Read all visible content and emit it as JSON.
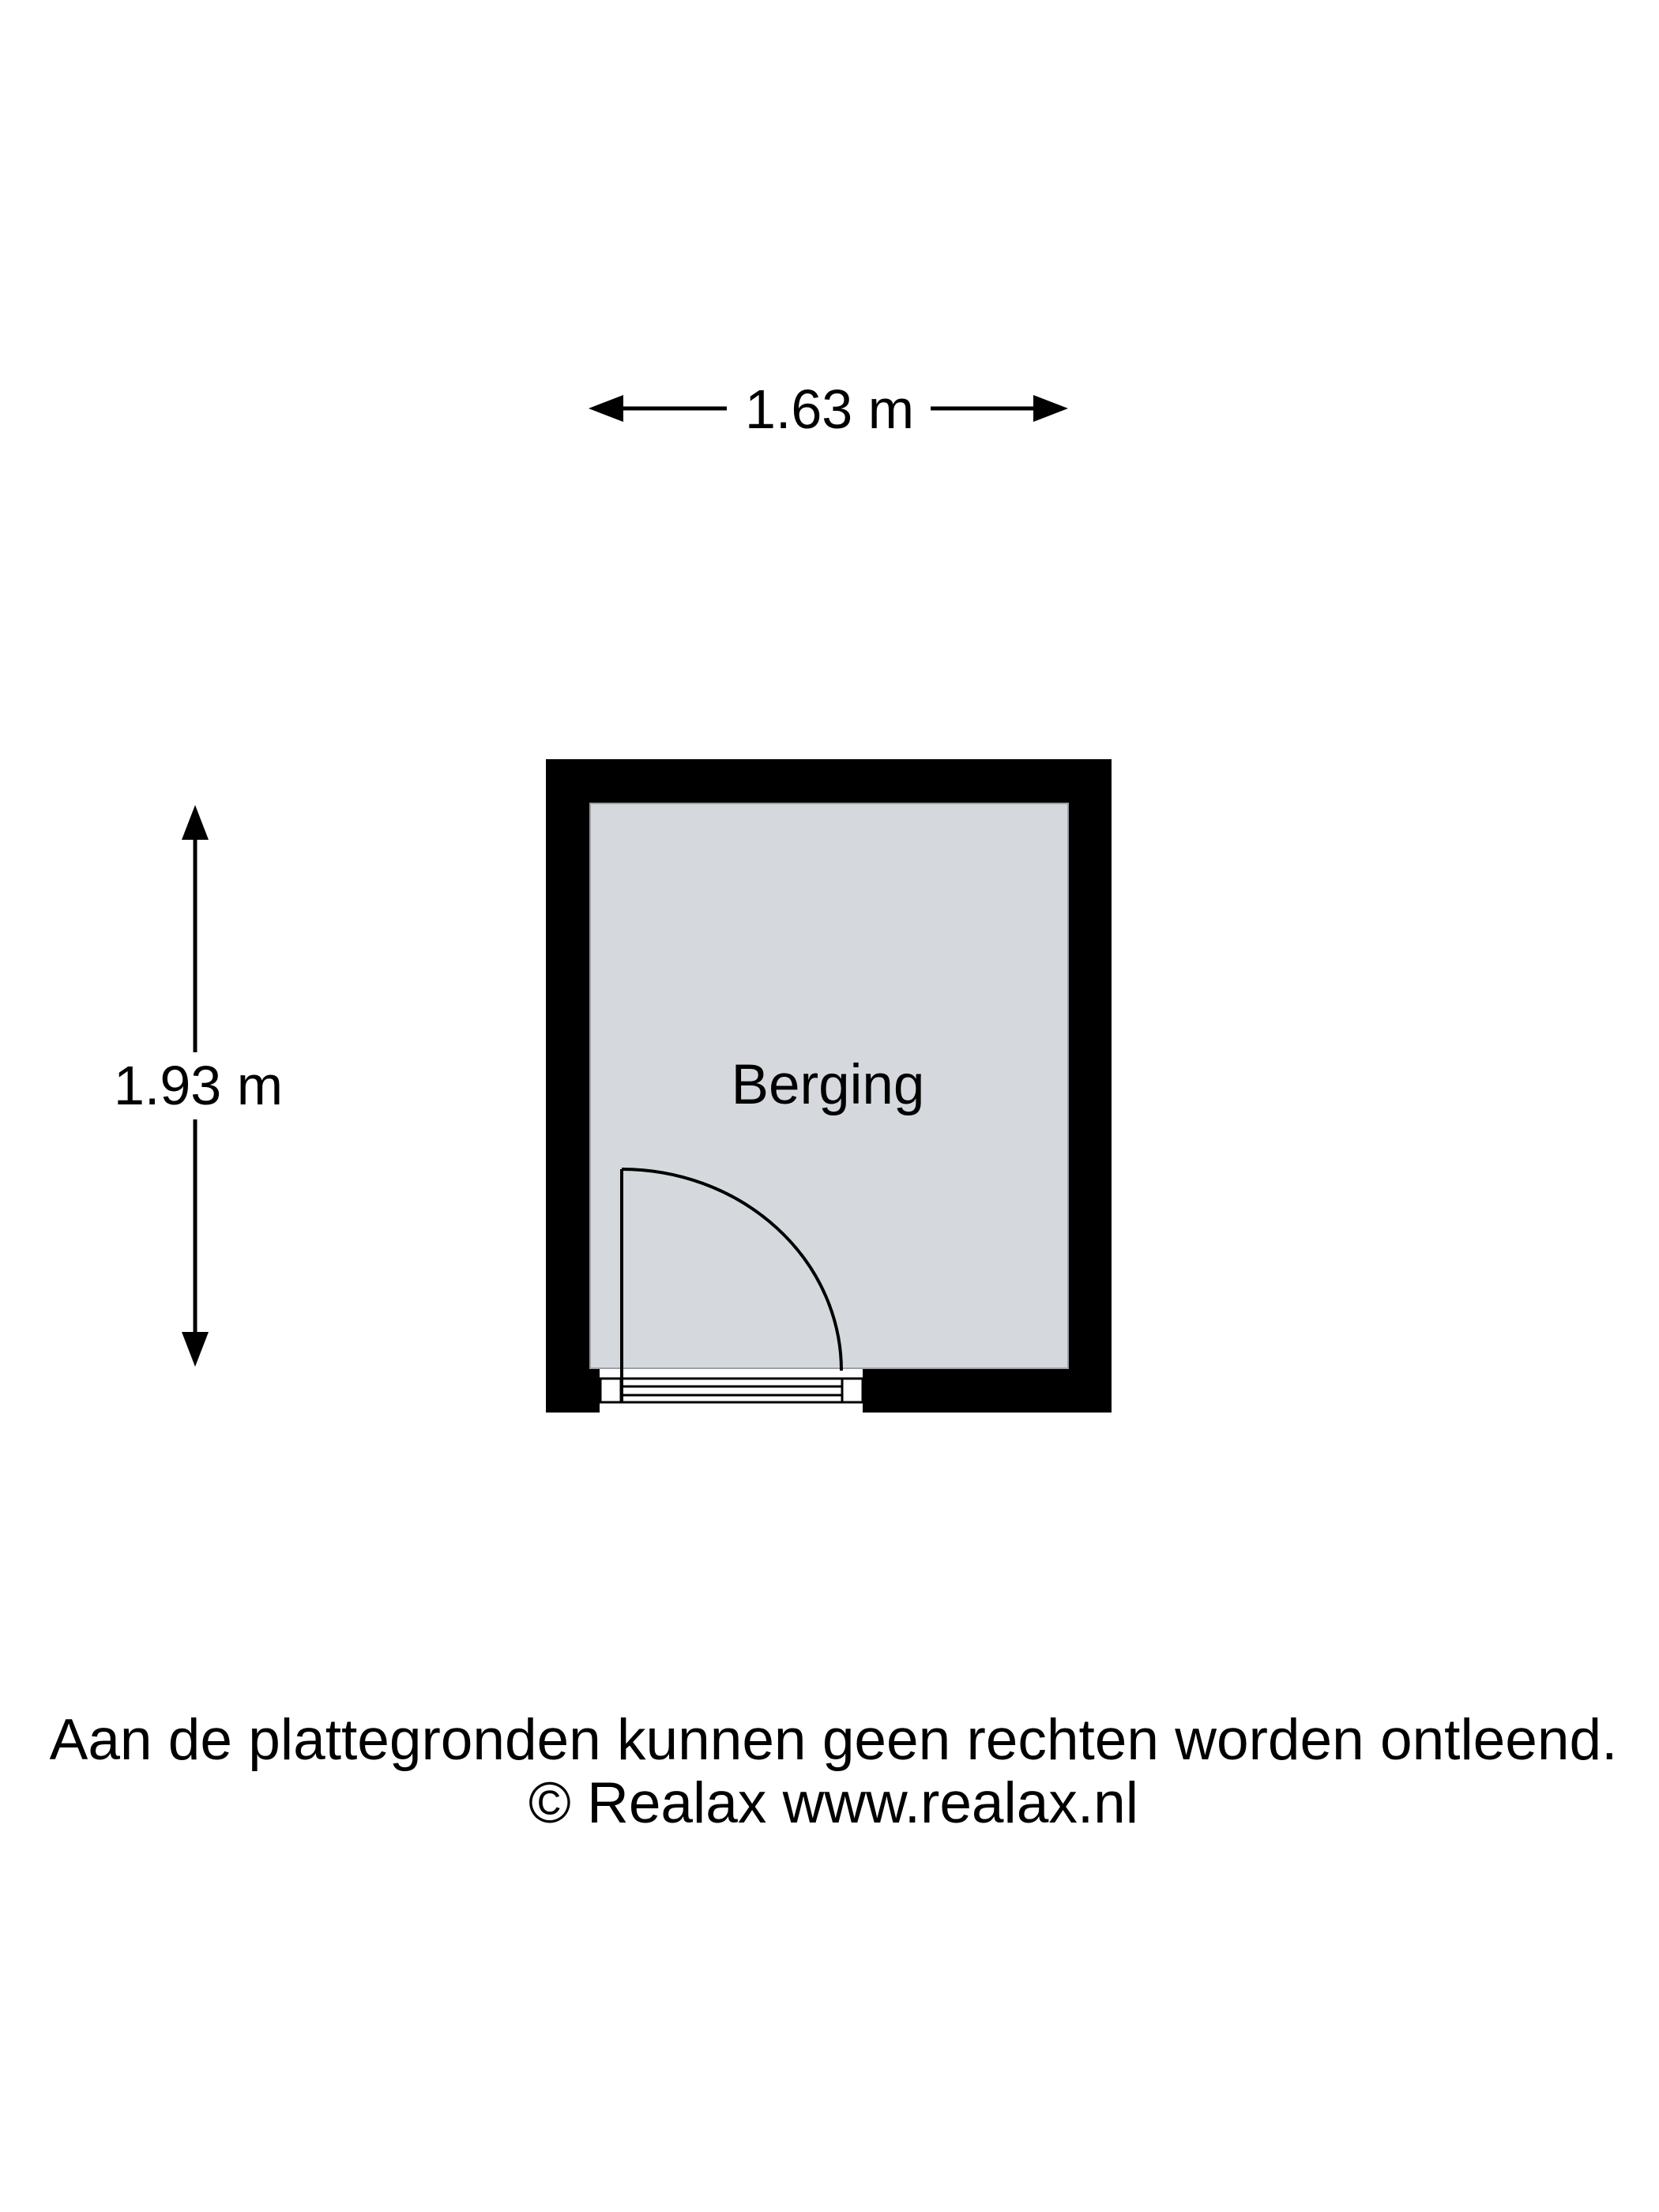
{
  "page": {
    "background": "#ffffff"
  },
  "floorplan": {
    "room_label": "Berging",
    "colors": {
      "wall": "#000000",
      "floor": "#d5d9dd",
      "floor_outline": "#9aa0a6",
      "line": "#000000"
    }
  },
  "dimensions": {
    "width_label": "1.63 m",
    "height_label": "1.93 m"
  },
  "footer": {
    "disclaimer": "Aan de plattegronden kunnen geen rechten worden ontleend.",
    "copyright": "© Realax www.realax.nl"
  }
}
